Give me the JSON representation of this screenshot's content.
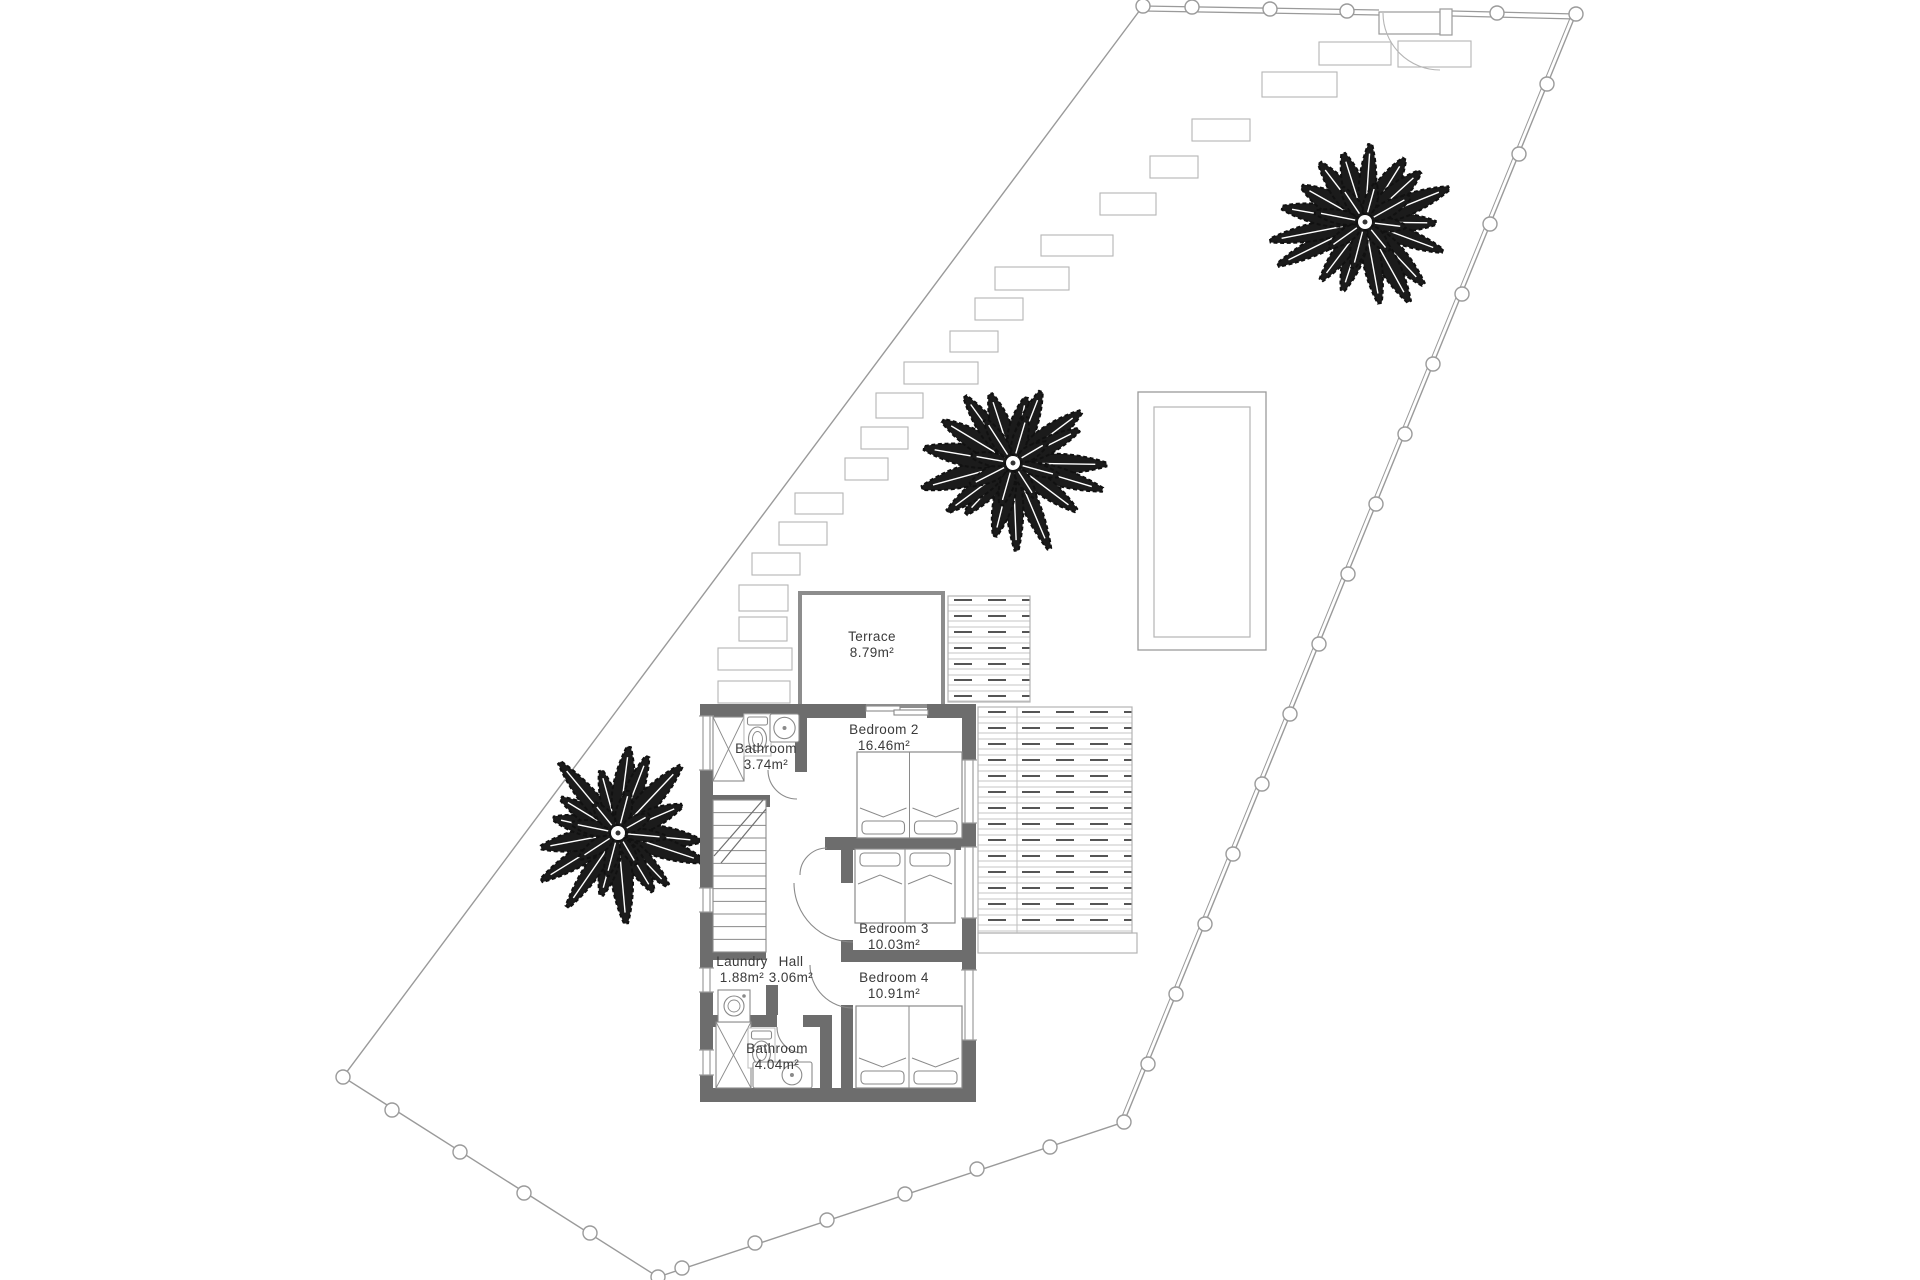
{
  "title": "Villa upper floor plan with plot",
  "colors": {
    "background": "#ffffff",
    "plot_line": "#9a9a9a",
    "wall": "#6d6d6d",
    "thin_wall": "#8d8d8d",
    "furniture": "#8a8a8a",
    "hatch_line": "#c6c6c6",
    "hatch_dash": "#555555",
    "tree": "#1b1b1b",
    "label": "#3a3a3a"
  },
  "rooms": [
    {
      "name": "Terrace",
      "area": "8.79m²",
      "x": 872,
      "y": 641
    },
    {
      "name": "Bedroom 2",
      "area": "16.46m²",
      "x": 884,
      "y": 734
    },
    {
      "name": "Bathroom",
      "area": "3.74m²",
      "x": 766,
      "y": 753
    },
    {
      "name": "Bedroom 3",
      "area": "10.03m²",
      "x": 894,
      "y": 933
    },
    {
      "name": "Laundry",
      "area": "1.88m²",
      "x": 742,
      "y": 966
    },
    {
      "name": "Hall",
      "area": "3.06m²",
      "x": 791,
      "y": 966
    },
    {
      "name": "Bedroom 4",
      "area": "10.91m²",
      "x": 894,
      "y": 982
    },
    {
      "name": "Bathroom",
      "area": "4.04m²",
      "x": 777,
      "y": 1053
    }
  ],
  "label_font_size": 13.5,
  "plot": {
    "boundary_path": "M 1576 14 L 1124 1122 L 658 1277 L 343 1077 L 1143 6",
    "right_double_line": [
      1572.3,
      12.5,
      1120.3,
      1120.5
    ],
    "fence_top_segments": [
      [
        1143,
        6,
        1379,
        10
      ],
      [
        1452,
        11,
        1576,
        14
      ],
      [
        1143,
        11,
        1379,
        15
      ],
      [
        1452,
        16,
        1576,
        19
      ]
    ],
    "gate": {
      "frame": [
        1379,
        12,
        67,
        22
      ],
      "leaf": [
        1440,
        9,
        12,
        26
      ],
      "arc": "M 1383 13 A 57 57 0 0 0 1440 70"
    },
    "posts": [
      [
        1143,
        6
      ],
      [
        1192,
        7
      ],
      [
        1270,
        9
      ],
      [
        1347,
        11
      ],
      [
        1497,
        13
      ],
      [
        1576,
        14
      ],
      [
        1547,
        84
      ],
      [
        1519,
        154
      ],
      [
        1490,
        224
      ],
      [
        1462,
        294
      ],
      [
        1433,
        364
      ],
      [
        1405,
        434
      ],
      [
        1376,
        504
      ],
      [
        1348,
        574
      ],
      [
        1319,
        644
      ],
      [
        1290,
        714
      ],
      [
        1262,
        784
      ],
      [
        1233,
        854
      ],
      [
        1205,
        924
      ],
      [
        1176,
        994
      ],
      [
        1148,
        1064
      ],
      [
        1124,
        1122
      ],
      [
        1050,
        1147
      ],
      [
        977,
        1169
      ],
      [
        905,
        1194
      ],
      [
        827,
        1220
      ],
      [
        755,
        1243
      ],
      [
        682,
        1268
      ],
      [
        658,
        1277
      ],
      [
        590,
        1233
      ],
      [
        524,
        1193
      ],
      [
        460,
        1152
      ],
      [
        392,
        1110
      ],
      [
        343,
        1077
      ]
    ],
    "post_radius": 7
  },
  "stones": [
    [
      718,
      681,
      72,
      22
    ],
    [
      718,
      648,
      74,
      22
    ],
    [
      739,
      617,
      48,
      24
    ],
    [
      739,
      585,
      49,
      26
    ],
    [
      752,
      553,
      48,
      22
    ],
    [
      779,
      522,
      48,
      23
    ],
    [
      795,
      493,
      48,
      21
    ],
    [
      845,
      458,
      43,
      22
    ],
    [
      861,
      427,
      47,
      22
    ],
    [
      876,
      393,
      47,
      25
    ],
    [
      904,
      362,
      74,
      22
    ],
    [
      950,
      331,
      48,
      21
    ],
    [
      975,
      298,
      48,
      22
    ],
    [
      995,
      267,
      74,
      23
    ],
    [
      1041,
      235,
      72,
      21
    ],
    [
      1100,
      193,
      56,
      22
    ],
    [
      1150,
      156,
      48,
      22
    ],
    [
      1192,
      119,
      58,
      22
    ],
    [
      1262,
      72,
      75,
      25
    ],
    [
      1319,
      42,
      72,
      23
    ],
    [
      1398,
      41,
      73,
      26
    ]
  ],
  "trees": [
    {
      "cx": 1365,
      "cy": 222,
      "r": 96,
      "seed": 7
    },
    {
      "cx": 1013,
      "cy": 463,
      "r": 95,
      "seed": 13
    },
    {
      "cx": 618,
      "cy": 833,
      "r": 92,
      "seed": 29
    }
  ],
  "pool": {
    "outer": [
      1138,
      392,
      128,
      258
    ],
    "inner": [
      1154,
      407,
      96,
      230
    ]
  },
  "decks": [
    {
      "x": 948,
      "y": 596,
      "w": 82,
      "h": 106,
      "hatch": true
    },
    {
      "x": 978,
      "y": 707,
      "w": 154,
      "h": 226,
      "hatch": true
    },
    {
      "x": 978,
      "y": 933,
      "w": 159,
      "h": 20,
      "hatch": false
    }
  ],
  "deck_lines": [
    [
      1017,
      707,
      1017,
      933
    ]
  ],
  "terrace": {
    "rect": [
      800,
      593,
      143,
      113
    ],
    "wall_width": 4
  },
  "house": {
    "walls": [
      [
        700,
        704,
        166,
        14
      ],
      [
        927,
        704,
        49,
        14
      ],
      [
        700,
        770,
        13,
        118
      ],
      [
        700,
        912,
        13,
        56
      ],
      [
        700,
        992,
        13,
        58
      ],
      [
        700,
        1075,
        13,
        20
      ],
      [
        962,
        713,
        14,
        47
      ],
      [
        962,
        823,
        14,
        24
      ],
      [
        962,
        918,
        14,
        52
      ],
      [
        962,
        1040,
        14,
        50
      ],
      [
        700,
        1088,
        276,
        14
      ],
      [
        795,
        713,
        12,
        59
      ],
      [
        713,
        795,
        57,
        12
      ],
      [
        825,
        837,
        137,
        13
      ],
      [
        841,
        850,
        12,
        33
      ],
      [
        841,
        940,
        12,
        22
      ],
      [
        841,
        1005,
        12,
        83
      ],
      [
        853,
        950,
        109,
        12
      ],
      [
        713,
        950,
        53,
        10
      ],
      [
        766,
        985,
        12,
        30
      ],
      [
        713,
        1015,
        64,
        12
      ],
      [
        803,
        1015,
        29,
        12
      ],
      [
        820,
        1027,
        12,
        61
      ]
    ],
    "windows": [
      [
        700,
        716,
        13,
        54
      ],
      [
        700,
        888,
        13,
        24
      ],
      [
        700,
        968,
        13,
        24
      ],
      [
        700,
        1050,
        13,
        25
      ],
      [
        962,
        760,
        14,
        63
      ],
      [
        962,
        847,
        14,
        71
      ],
      [
        962,
        970,
        14,
        70
      ]
    ],
    "slider_panels": [
      [
        866,
        706,
        34,
        5
      ],
      [
        894,
        710,
        34,
        5
      ]
    ]
  },
  "stairs": {
    "x": 713,
    "y": 800,
    "w": 53,
    "h": 152,
    "treads": 11,
    "break_lines": [
      [
        714,
        856,
        763,
        800
      ],
      [
        721,
        863,
        766,
        809
      ]
    ]
  },
  "beds": [
    {
      "x": 857,
      "y": 752,
      "w": 105,
      "h": 86,
      "head": "bottom"
    },
    {
      "x": 855,
      "y": 849,
      "w": 100,
      "h": 74,
      "head": "top"
    },
    {
      "x": 856,
      "y": 1006,
      "w": 106,
      "h": 82,
      "head": "bottom"
    }
  ],
  "fixtures": {
    "showers": [
      {
        "x": 713,
        "y": 717,
        "w": 31,
        "h": 64
      },
      {
        "x": 716,
        "y": 1022,
        "w": 35,
        "h": 66
      }
    ],
    "toilets": [
      {
        "x": 744,
        "y": 714,
        "w": 27,
        "h": 42
      },
      {
        "x": 748,
        "y": 1028,
        "w": 27,
        "h": 40
      }
    ],
    "sinks": [
      {
        "x": 770,
        "y": 714,
        "w": 29,
        "h": 28
      },
      {
        "x": 753,
        "y": 1062,
        "w": 59,
        "h": 26
      }
    ],
    "washer": {
      "x": 718,
      "y": 990,
      "w": 32,
      "h": 32
    }
  },
  "doors": [
    {
      "name": "bathroom-top-door",
      "arc": "M 768 770 A 29 29 0 0 0 797 799"
    },
    {
      "name": "bedroom3-door",
      "arc": "M 794 883 A 59 59 0 0 0 853 942"
    },
    {
      "name": "bedroom4-door",
      "arc": "M 810 965 A 43 43 0 0 0 853 1008"
    },
    {
      "name": "bathroom-bottom-door",
      "arc": "M 777 1027 A 26 26 0 0 0 803 1053"
    },
    {
      "name": "bedroom2-door",
      "arc": "M 800 875 A 27 27 0 0 1 827 848"
    }
  ]
}
